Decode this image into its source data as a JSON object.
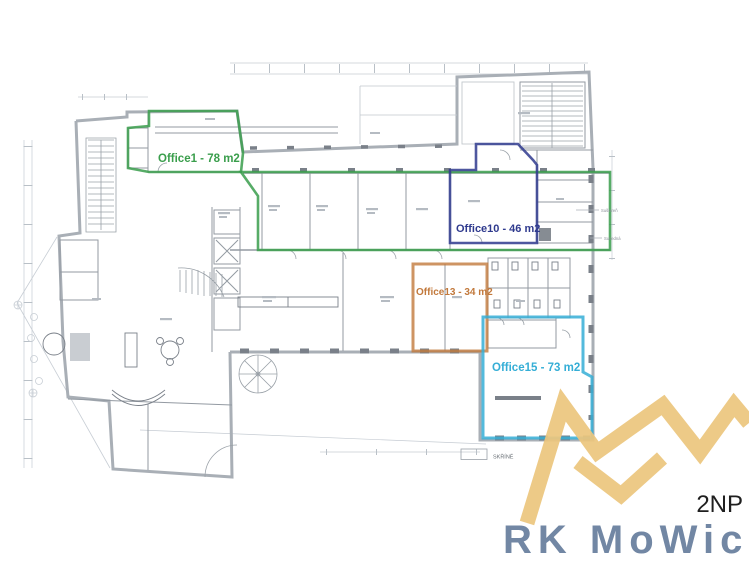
{
  "floor_plan": {
    "offices": [
      {
        "name": "office-1",
        "label": "Office1 - 78 m2",
        "color": "#3a9e4c"
      },
      {
        "name": "office-10",
        "label": "Office10 - 46 m2",
        "color": "#2f3a8e"
      },
      {
        "name": "office-13",
        "label": "Office13 - 34 m2",
        "color": "#c2793c"
      },
      {
        "name": "office-15",
        "label": "Office15 - 73 m2",
        "color": "#35aed6"
      }
    ],
    "side_annotations": {
      "top": "Sušiareň",
      "bottom": "Susedná"
    },
    "legend": {
      "label": "SKŘÍNĚ"
    },
    "watermark": {
      "level": "2NP",
      "brand": "RK MoWic"
    },
    "colors": {
      "gold": "#ecc67e",
      "brand": "#7287a4",
      "level": "#1f1f1f"
    }
  }
}
